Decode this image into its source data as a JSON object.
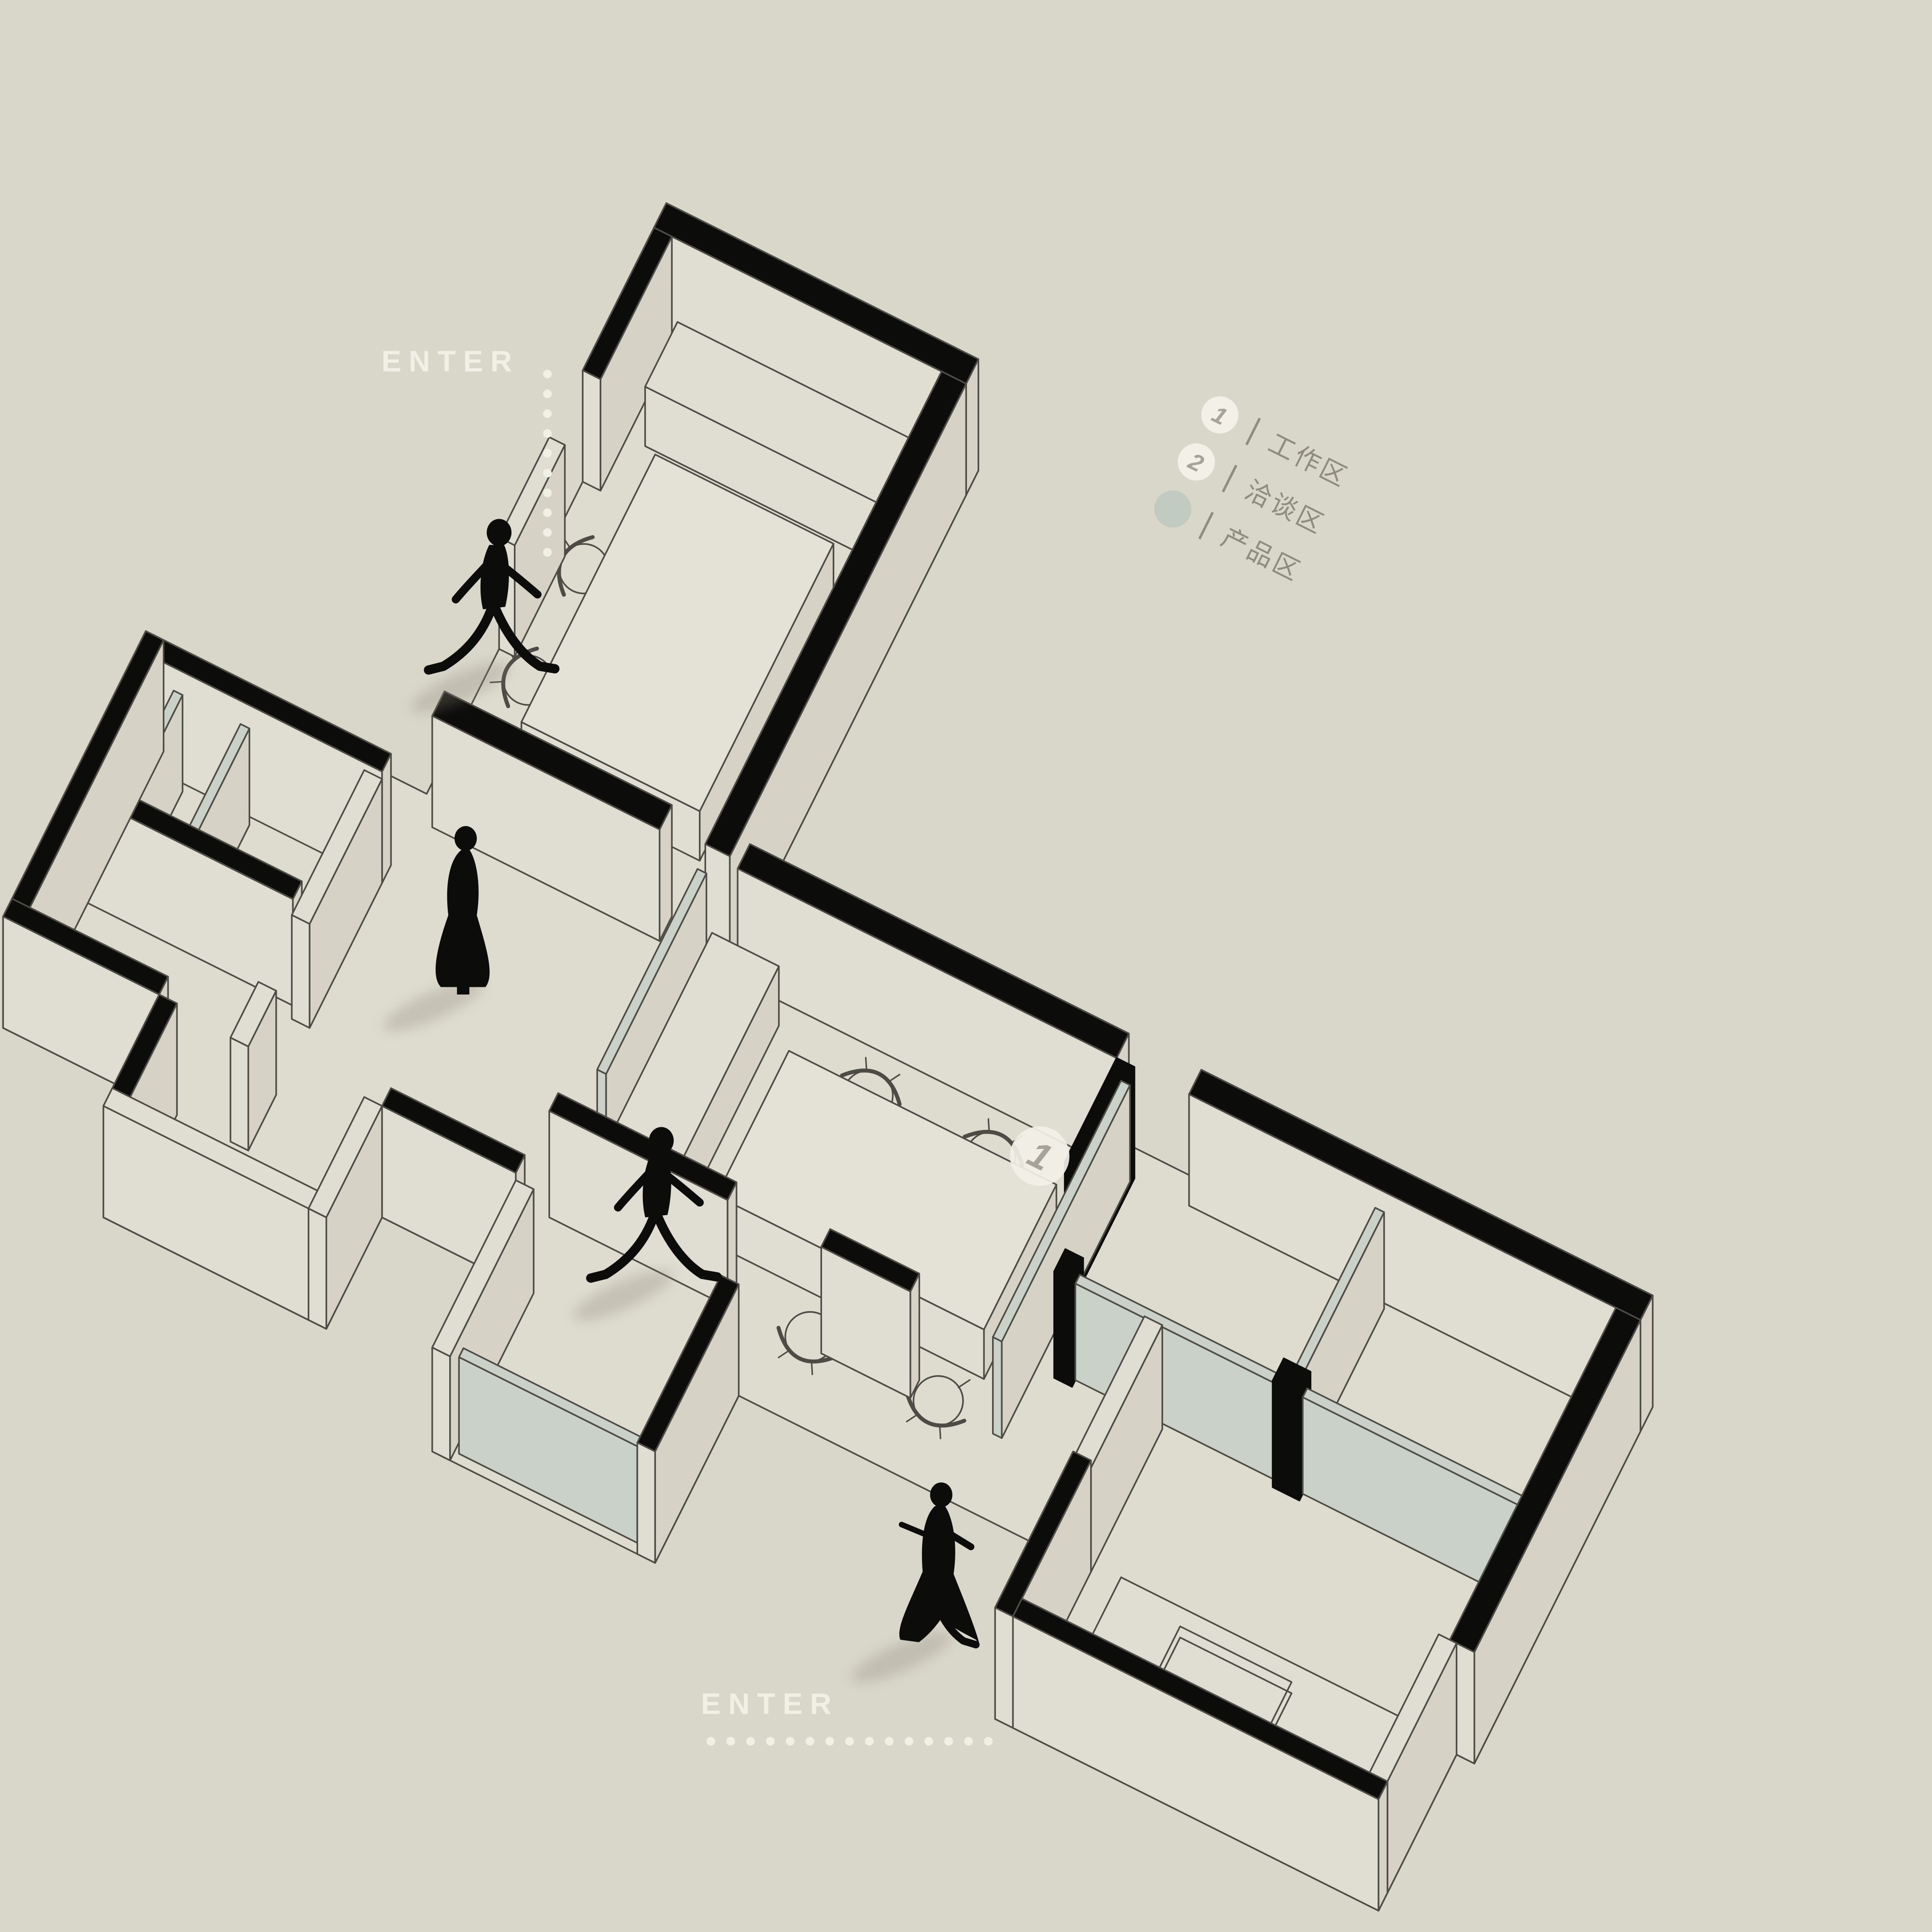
{
  "page": {
    "title": "Axonometric office floor plan diagram"
  },
  "colors": {
    "background": "#d9d6ca",
    "floor": "#dedbcf",
    "wall_black": "#0c0c0a",
    "wall_face": "#e0ddd2",
    "wall_face_shade": "#d6d3c6",
    "glass": "#c9d1c8",
    "glass_edge": "#70756c",
    "outline": "#4d4b45",
    "legend_text": "#8f8b81",
    "marker_circle": "#f2f0e7",
    "marker_number": "#a7a399",
    "product_dot": "#c2cbc1",
    "enter_text": "#f2f0e5",
    "shadow": "#8a8578"
  },
  "legend": {
    "items": [
      {
        "marker": "1",
        "label": "工作区"
      },
      {
        "marker": "2",
        "label": "洽谈区"
      },
      {
        "marker": "dot",
        "label": "产品区"
      }
    ]
  },
  "area_markers": [
    {
      "number": "1",
      "label": "工作区"
    },
    {
      "number": "2",
      "label": "洽谈区"
    }
  ],
  "entrances": [
    {
      "id": "top-left",
      "label": "ENTER",
      "line": "vertical-dotted"
    },
    {
      "id": "bottom-center",
      "label": "ENTER",
      "line": "horizontal-dotted"
    }
  ],
  "figures": [
    {
      "type": "walking-man"
    },
    {
      "type": "standing-woman"
    },
    {
      "type": "walking-man"
    },
    {
      "type": "walking-woman"
    }
  ]
}
